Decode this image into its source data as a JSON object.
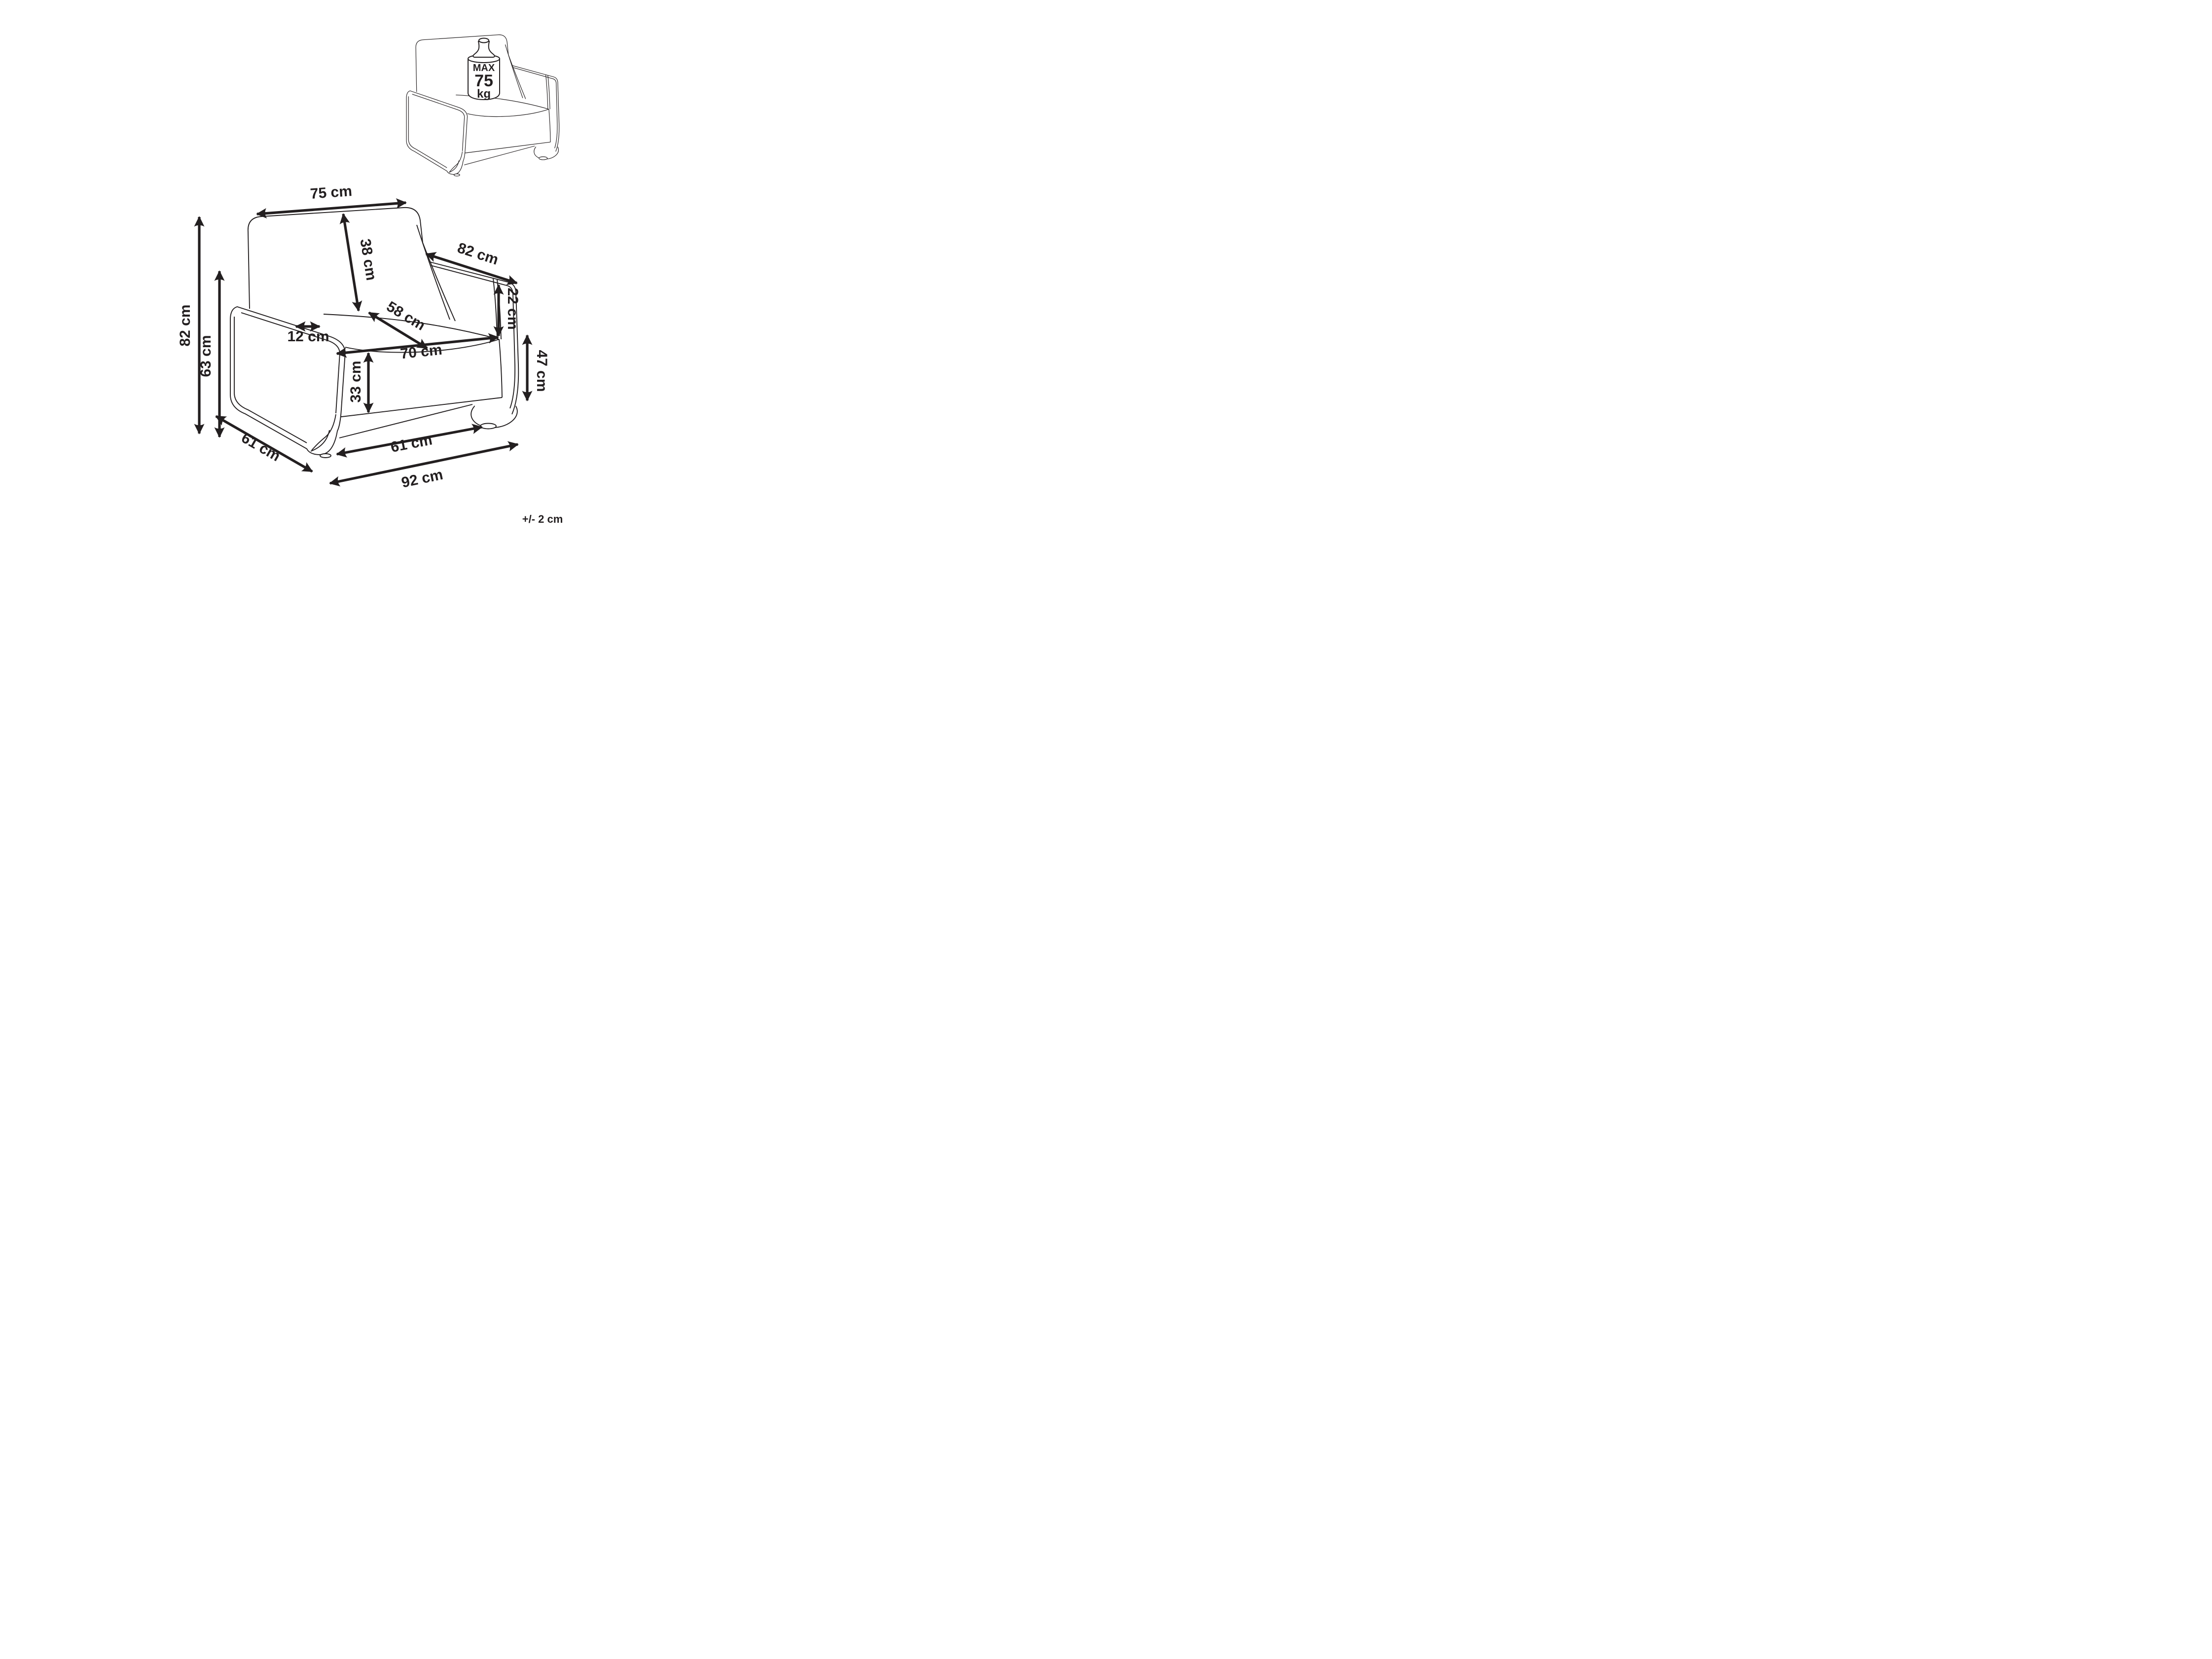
{
  "diagram": {
    "type": "furniture-dimension-drawing",
    "subject": "armchair",
    "tolerance_note": "+/- 2 cm"
  },
  "colors": {
    "ink": "#231f20",
    "background": "#ffffff"
  },
  "inset": {
    "description": "armchair with max load weight icon",
    "max_label": "MAX",
    "max_value": "75",
    "max_unit": "kg"
  },
  "dimensions": {
    "back_width": "75 cm",
    "backrest_height": "38 cm",
    "armrest_length": "82 cm",
    "backrest_above_arm": "22 cm",
    "seat_depth": "58 cm",
    "armrest_thickness": "12 cm",
    "seat_width": "70 cm",
    "seat_front_height": "33 cm",
    "arm_front_height": "47 cm",
    "total_height": "82 cm",
    "arm_height": "63 cm",
    "side_depth": "61 cm",
    "feet_span": "61 cm",
    "total_width": "92 cm"
  }
}
